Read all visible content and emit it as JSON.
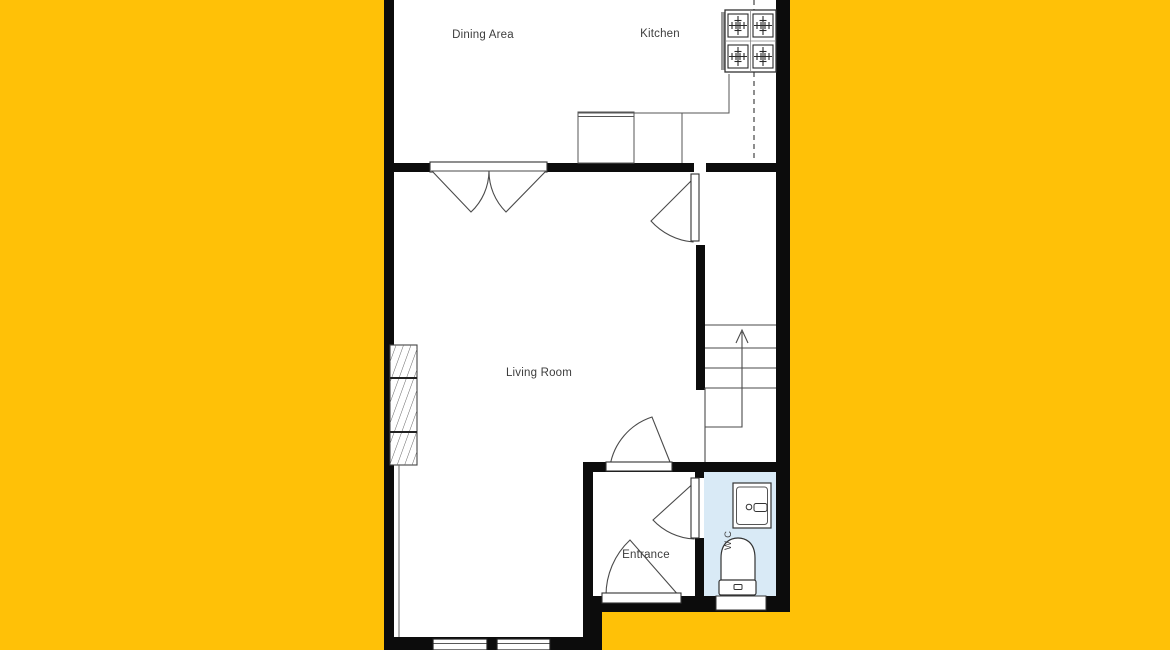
{
  "page": {
    "background_color": "#FFC107",
    "content_type": "floor-plan"
  },
  "plan": {
    "colors": {
      "wall": "#0C0C0C",
      "floor": "#FFFFFF",
      "thin_line": "#4A4A4A",
      "counter_line": "#555555",
      "text": "#3D3D3D",
      "wc_fill": "#D9EAF6",
      "stove_side_bar": "#999999"
    },
    "rooms": {
      "dining": {
        "label": "Dining Area"
      },
      "kitchen": {
        "label": "Kitchen"
      },
      "living": {
        "label": "Living Room"
      },
      "entrance": {
        "label": "Entrance"
      },
      "wc": {
        "label": "W.C"
      }
    },
    "fixtures": [
      {
        "name": "stove-4-burners",
        "room": "kitchen"
      },
      {
        "name": "kitchen-counter",
        "room": "kitchen"
      },
      {
        "name": "radiator-hatched",
        "room": "living"
      },
      {
        "name": "staircase-up-arrow",
        "room": "stair-hall"
      },
      {
        "name": "double-door",
        "between": "dining / living"
      },
      {
        "name": "washbasin",
        "room": "wc"
      },
      {
        "name": "toilet",
        "room": "wc"
      },
      {
        "name": "windows",
        "room": "living / wc"
      }
    ]
  }
}
